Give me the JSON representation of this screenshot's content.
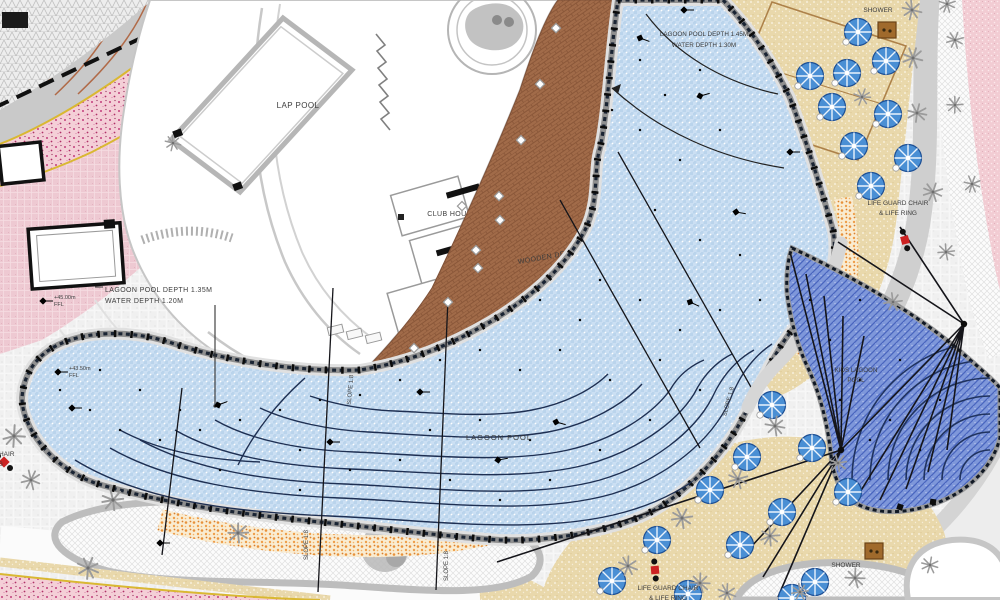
{
  "labels": {
    "lap_pool": "LAP POOL",
    "club_house": "CLUB HOUSE",
    "wooden_deck": "WOODEN DECK",
    "lagoon_pool": "LAGOON POOL",
    "kids_pool_line1": "KIDS LAGOON",
    "kids_pool_line2": "POOL",
    "shower": "SHOWER",
    "lifeguard_line1": "LIFE GUARD CHAIR",
    "lifeguard_line2": "& LIFE RING",
    "slope": "SLOPE 1:8",
    "depth_left_line1": "LAGOON POOL DEPTH 1.35M",
    "depth_left_line2": "WATER DEPTH 1.20M",
    "depth_top_line1": "LAGOON POOL DEPTH 1.45M",
    "depth_top_line2": "WATER DEPTH 1.30M",
    "spot_level_a": "+45.00m",
    "spot_level_b": "+43.50m",
    "ffl": "FFL"
  },
  "colors": {
    "lagoon_water": "#cbdff3",
    "kids_water": "#7e97da",
    "sand": "#e9d8ab",
    "beach_entry_orange": "#e8913a",
    "wooden_deck_brown": "#a16b49",
    "planting_pink": "#f4cfd7",
    "umbrella_blue": "#4a8fd4",
    "lifeguard_red": "#cc2222"
  }
}
